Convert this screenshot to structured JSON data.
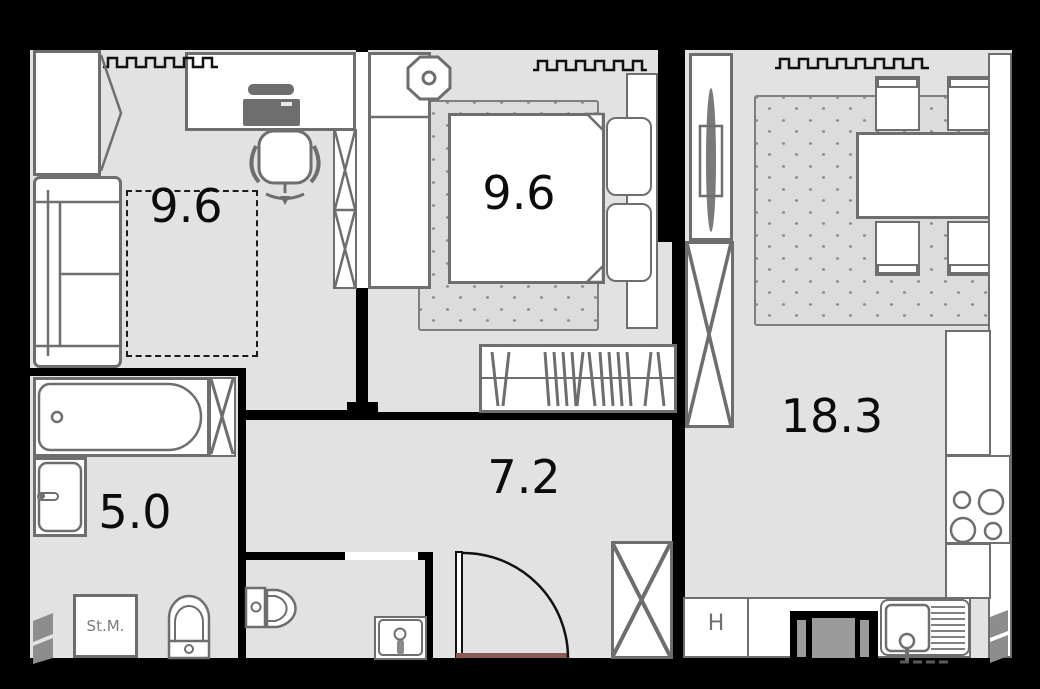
{
  "plan": {
    "type": "apartment-floor-plan",
    "rooms": [
      {
        "name": "study",
        "area_label": "9.6"
      },
      {
        "name": "bedroom",
        "area_label": "9.6"
      },
      {
        "name": "living-kitchen",
        "area_label": "18.3"
      },
      {
        "name": "hallway",
        "area_label": "7.2"
      },
      {
        "name": "bathroom",
        "area_label": "5.0"
      },
      {
        "name": "wc",
        "area_label": ""
      }
    ],
    "appliance_labels": {
      "washing_machine": "St.M.",
      "fridge": "H"
    },
    "colors": {
      "wall": "#000000",
      "floor": "#e2e2e2",
      "furniture_fill": "#ffffff",
      "furniture_stroke": "#6e6e6e",
      "carpet_dot": "#8d8d8d",
      "door_threshold": "#8a5b55",
      "label_text": "#0c0c0c",
      "appliance_text": "#7c7c7c"
    }
  }
}
